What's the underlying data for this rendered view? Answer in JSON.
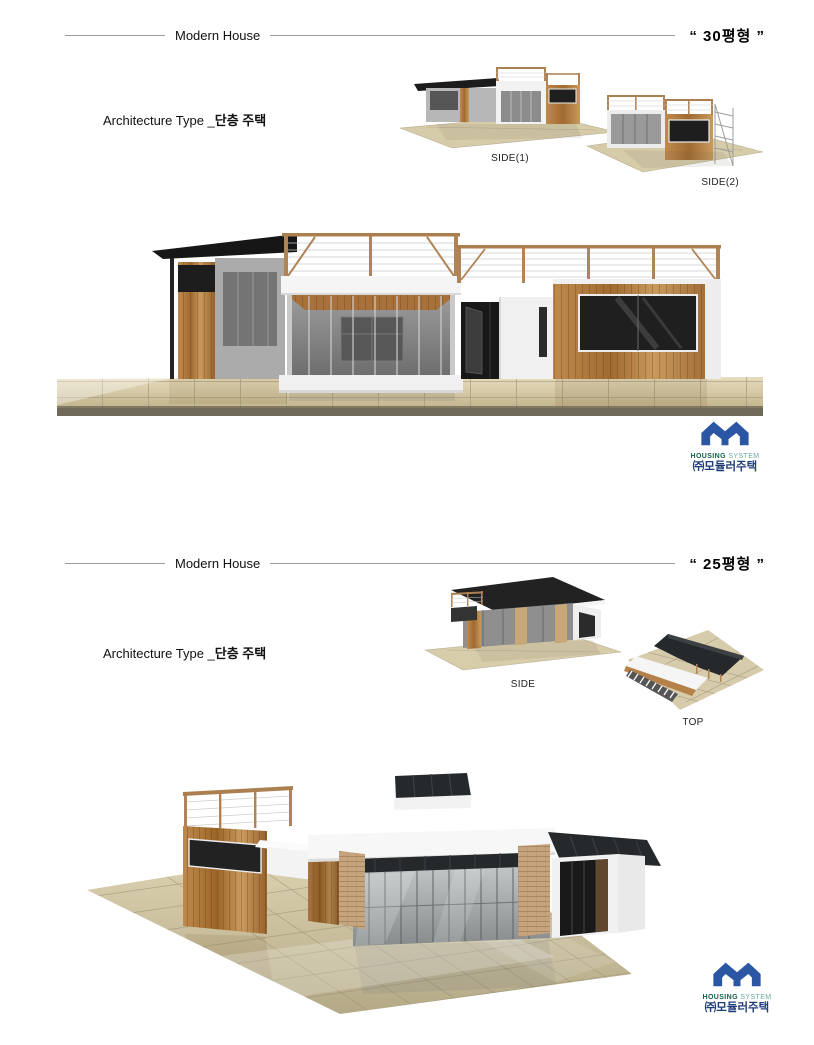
{
  "document": {
    "sections": [
      {
        "header": {
          "rule_title": "Modern House",
          "size_quote": "“ 30평형 ”"
        },
        "subtitle": {
          "prefix": "Architecture Type _",
          "emphasis": "단층 주택"
        },
        "views": [
          {
            "label": "SIDE(1)"
          },
          {
            "label": "SIDE(2)"
          }
        ],
        "logo": {
          "line1_bold": "HOUSING",
          "line1_light": "SYSTEM",
          "line2": "㈜모듈러주택"
        }
      },
      {
        "header": {
          "rule_title": "Modern House",
          "size_quote": "“ 25평형 ”"
        },
        "subtitle": {
          "prefix": "Architecture Type _",
          "emphasis": "단층 주택"
        },
        "views": [
          {
            "label": "SIDE"
          },
          {
            "label": "TOP"
          }
        ],
        "logo": {
          "line1_bold": "HOUSING",
          "line1_light": "SYSTEM",
          "line2": "㈜모듈러주택"
        }
      }
    ],
    "colors": {
      "logo_blue": "#2b56a4",
      "logo_green": "#136049",
      "logo_teal": "#6aa79f",
      "logo_navy": "#1e3c78",
      "roof_charcoal": "#1f1f1f",
      "wood": "#b5804a",
      "floor_beige": "#cfc3a2",
      "header_rule": "#9b9b9b"
    }
  }
}
